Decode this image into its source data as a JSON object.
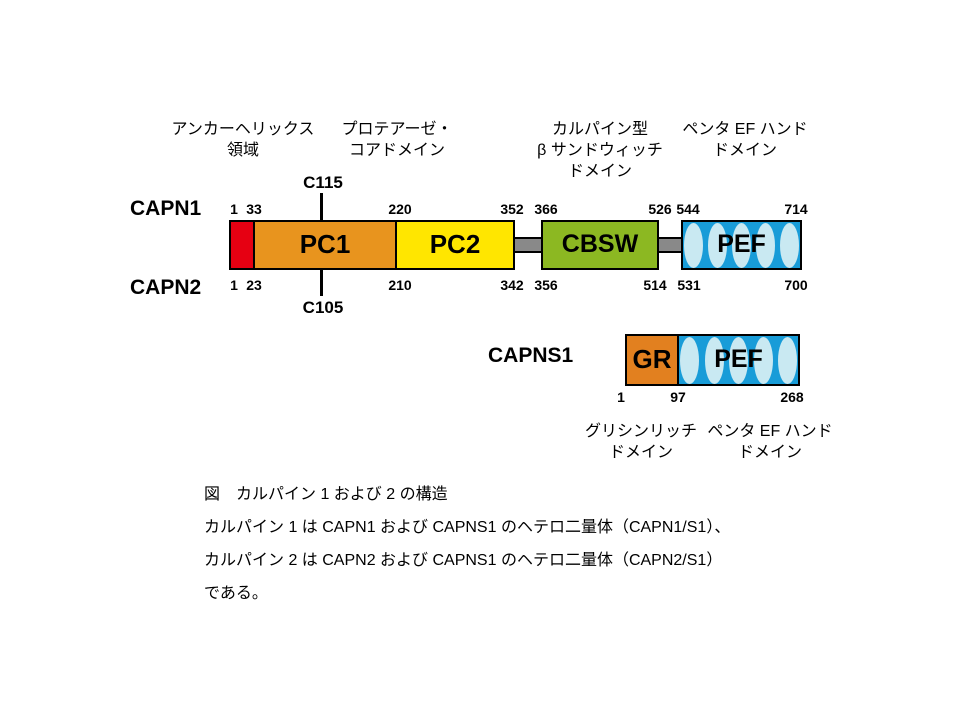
{
  "diagram": {
    "annotations_top": [
      [
        "アンカーヘリックス",
        "領域"
      ],
      [
        "プロテアーゼ・",
        "コアドメイン"
      ],
      [
        "カルパイン型",
        "β サンドウィッチ",
        "ドメイン"
      ],
      [
        "ペンタ EF ハンド",
        "ドメイン"
      ]
    ],
    "capn1_name": "CAPN1",
    "capn2_name": "CAPN2",
    "capns1_name": "CAPNS1",
    "active_sites": {
      "top": "C115",
      "bottom": "C105"
    },
    "capn1_ticks": [
      "1",
      "33",
      "220",
      "352",
      "366",
      "526",
      "544",
      "714"
    ],
    "capn2_ticks": [
      "1",
      "23",
      "210",
      "342",
      "356",
      "514",
      "531",
      "700"
    ],
    "capns1_ticks": [
      "1",
      "97",
      "268"
    ],
    "domain_labels": {
      "pc1": "PC1",
      "pc2": "PC2",
      "cbsw": "CBSW",
      "pef": "PEF",
      "gr": "GR"
    },
    "annotations_bottom": [
      [
        "グリシンリッチ",
        "ドメイン"
      ],
      [
        "ペンタ EF ハンド",
        "ドメイン"
      ]
    ],
    "colors": {
      "anchor_red": "#e60012",
      "pc1_orange": "#e8941e",
      "pc2_yellow": "#ffe600",
      "cbsw_green": "#8cb822",
      "pef_blue": "#189cd8",
      "ef_motif_light": "#c9e9f2",
      "gr_orange": "#e2801f",
      "linker_gray": "#898989"
    }
  },
  "caption": {
    "lines": [
      "図　カルパイン 1 および 2 の構造",
      "カルパイン 1 は CAPN1 および CAPNS1 のヘテロ二量体（CAPN1/S1）、",
      "カルパイン 2 は CAPN2 および CAPNS1 のヘテロ二量体（CAPN2/S1）",
      "である。"
    ]
  }
}
